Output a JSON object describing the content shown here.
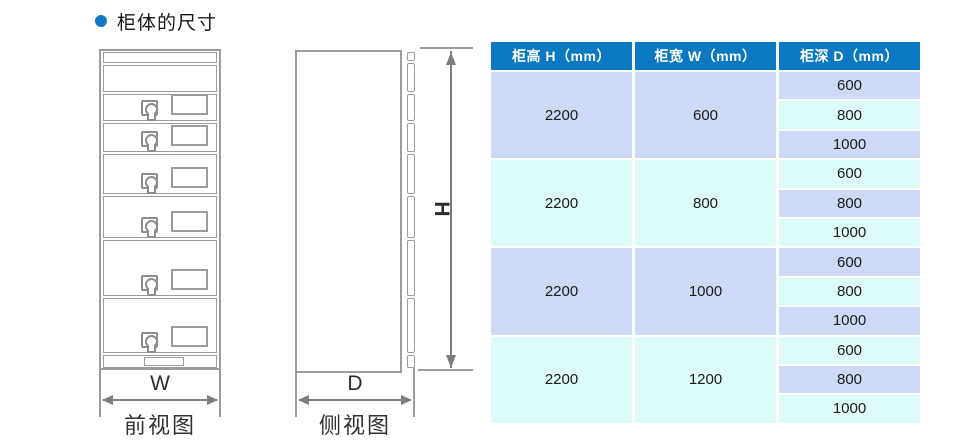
{
  "title": {
    "text": "柜体的尺寸"
  },
  "front_view": {
    "caption": "前视图",
    "width_dim_label": "W",
    "drawer_count": 6
  },
  "side_view": {
    "caption": "侧视图",
    "depth_dim_label": "D",
    "height_dim_label": "H"
  },
  "table": {
    "headers": [
      "柜高 H（mm）",
      "柜宽 W（mm）",
      "柜深 D（mm）"
    ],
    "groups": [
      {
        "cabinet_height": "2200",
        "cabinet_width": "600",
        "cabinet_depths": [
          "600",
          "800",
          "1000"
        ]
      },
      {
        "cabinet_height": "2200",
        "cabinet_width": "800",
        "cabinet_depths": [
          "600",
          "800",
          "1000"
        ]
      },
      {
        "cabinet_height": "2200",
        "cabinet_width": "1000",
        "cabinet_depths": [
          "600",
          "800",
          "1000"
        ]
      },
      {
        "cabinet_height": "2200",
        "cabinet_width": "1200",
        "cabinet_depths": [
          "600",
          "800",
          "1000"
        ]
      }
    ]
  },
  "colors": {
    "accent_bullet": "#1178c2",
    "table_header_bg": "#0b79c1",
    "table_header_text": "#ffffff",
    "row_lavender": "#cdd9f5",
    "row_cyan": "#ddfcf9",
    "drawing_line_gray": "#9c9c9c",
    "dimension_arrow_gray": "#7d7d7d"
  }
}
